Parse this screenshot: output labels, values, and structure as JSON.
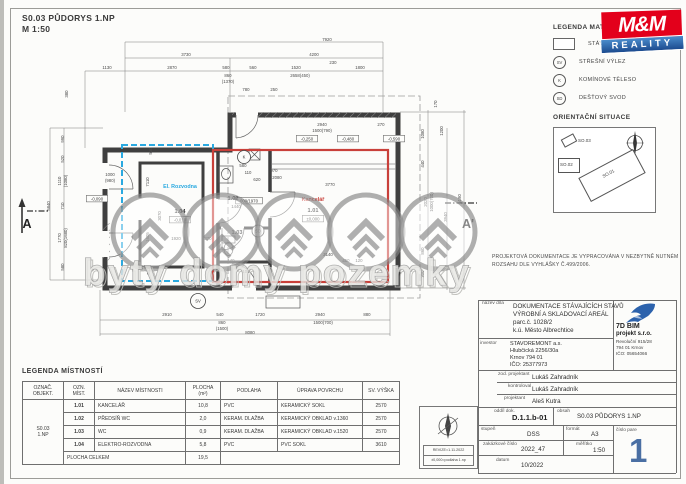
{
  "header": {
    "title": "S0.03 PŮDORYS 1.NP",
    "scale": "M 1:50"
  },
  "colors": {
    "accent_blue": "#2aa9e0",
    "accent_red": "#c9403a",
    "mm_red": "#e3001b",
    "mm_blue_top": "#4a8ccc",
    "mm_blue_bottom": "#1c4b8f",
    "pare_blue": "#4a6fa3",
    "bird_blue": "#2c62ac"
  },
  "watermark": {
    "text": "byty domy pozemky"
  },
  "legend_materials": {
    "title": "LEGENDA MATERIÁLŮ",
    "items": [
      {
        "sym": "swatch",
        "label": "STÁVAJÍCÍ KONSTRUKCE"
      },
      {
        "sym": "SV",
        "label": "STŘEŠNÍ VÝLEZ"
      },
      {
        "sym": "K",
        "label": "KOMÍNOVÉ TĚLESO"
      },
      {
        "sym": "SD",
        "label": "DEŠŤOVÝ SVOD"
      }
    ]
  },
  "mm_logo": {
    "name": "M&M",
    "banner": "REALITY"
  },
  "orientation": {
    "title": "ORIENTAČNÍ SITUACE",
    "buildings": [
      {
        "cls": "so3",
        "label": "SO.03"
      },
      {
        "cls": "so2",
        "label": "SO.02"
      },
      {
        "cls": "so1",
        "label": "SO.01"
      }
    ]
  },
  "note": {
    "line1": "PROJEKTOVÁ DOKUMENTACE JE VYPRACOVÁNA V NEZBYTNĚ NUTNÉM",
    "line2": "ROZSAHU DLE VYHLÁŠKY Č.499/2006."
  },
  "title_block": {
    "nazev_label": "název díla",
    "nazev": [
      "DOKUMENTACE STÁVAJÍCÍCH STAVŮ",
      "VÝROBNÍ A SKLADOVACÍ AREÁL",
      "parc.č. 1028/2",
      "k.ú. Město Albrechtice"
    ],
    "investor_label": "investor",
    "investor": [
      "STAVOREMONT a.s.",
      "Hlubčická 2256/30a",
      "Krnov 794 01",
      "IČO: 25377973"
    ],
    "company": {
      "name": "7D BIM",
      "name2": "projekt s.r.o.",
      "addr": [
        "Revoluční 915/28",
        "794 01 Krnov",
        "IČO: 05654066"
      ]
    },
    "zod_label": "zod. projektant",
    "zod": "Lukáš Zahradník",
    "kontroloval_label": "kontroloval",
    "kontroloval": "Lukáš Zahradník",
    "projektant_label": "projektant",
    "projektant": "Aleš Kutra",
    "oddil_label": "oddíl dok.",
    "oddil": "D.1.1.b-01",
    "obsah_label": "obsah",
    "obsah": "S0.03 PŮDORYS 1.NP",
    "stupen_label": "stupeň",
    "stupen": "DSS",
    "format_label": "formát",
    "format": "A3",
    "pare_label": "číslo pare",
    "pare": "1",
    "zakazka_label": "zakázkové číslo",
    "zakazka": "2022_47",
    "meritko_label": "měřítko",
    "meritko": "1:50",
    "datum_label": "datum",
    "datum": "10/2022"
  },
  "room_table": {
    "title": "LEGENDA MÍSTNOSTÍ",
    "headers": [
      "OZNAČ.\nOBJEKT.",
      "OZN.\nMÍST.",
      "NÁZEV MÍSTNOSTI",
      "PLOCHA\n(m²)",
      "PODLAHA",
      "ÚPRAVA POVRCHU",
      "SV. VÝŠKA"
    ],
    "group": "S0.03\n1.NP",
    "rows": [
      [
        "1.01",
        "KANCELÁŘ",
        "10,8",
        "PVC",
        "KERAMICKÝ SOKL",
        "2570"
      ],
      [
        "1.02",
        "PŘEDSÍŇ WC",
        "2,0",
        "KERAM. DLAŽBA",
        "KERAMICKÝ OBKLAD v.1360",
        "2570"
      ],
      [
        "1.03",
        "WC",
        "0,9",
        "KERAM. DLAŽBA",
        "KERAMICKÝ OBKLAD v.1520",
        "2570"
      ],
      [
        "1.04",
        "ELEKTRO-ROZVODNA",
        "5,8",
        "PVC",
        "PVC SOKL",
        "3610"
      ]
    ],
    "total_label": "PLOCHA CELKEM",
    "total": "19,5"
  },
  "revize": {
    "line1": "REVIZE=1.11.2022",
    "line2": "±0,000=podlaha 1.np"
  },
  "plan": {
    "dims": [
      {
        "t": "7920",
        "x": 327,
        "y": 41
      },
      {
        "t": "3730",
        "x": 186,
        "y": 56
      },
      {
        "t": "4200",
        "x": 314,
        "y": 56
      },
      {
        "t": "1130",
        "x": 107,
        "y": 69
      },
      {
        "t": "2870",
        "x": 172,
        "y": 69
      },
      {
        "t": "580",
        "x": 226,
        "y": 69
      },
      {
        "t": "560",
        "x": 253,
        "y": 69
      },
      {
        "t": "1520",
        "x": 296,
        "y": 69
      },
      {
        "t": "230",
        "x": 333,
        "y": 64
      },
      {
        "t": "1800",
        "x": 360,
        "y": 69
      },
      {
        "t": "860",
        "x": 228,
        "y": 77
      },
      {
        "t": "(1370)",
        "x": 228,
        "y": 83
      },
      {
        "t": "2658(450)",
        "x": 300,
        "y": 77
      },
      {
        "t": "780",
        "x": 246,
        "y": 91
      },
      {
        "t": "250",
        "x": 274,
        "y": 91
      },
      {
        "t": "380",
        "x": 68,
        "y": 94,
        "v": true
      },
      {
        "t": "2940",
        "x": 322,
        "y": 126
      },
      {
        "t": "1500(790)",
        "x": 322,
        "y": 132
      },
      {
        "t": "270",
        "x": 381,
        "y": 126
      },
      {
        "t": "990",
        "x": 64,
        "y": 139,
        "v": true
      },
      {
        "t": "520",
        "x": 64,
        "y": 159,
        "v": true
      },
      {
        "t": "1110",
        "x": 61,
        "y": 181,
        "v": true
      },
      {
        "t": "(1080)",
        "x": 67,
        "y": 181,
        "v": true
      },
      {
        "t": "710",
        "x": 64,
        "y": 206,
        "v": true
      },
      {
        "t": "1770",
        "x": 61,
        "y": 238,
        "v": true
      },
      {
        "t": "820(1680)",
        "x": 67,
        "y": 238,
        "v": true
      },
      {
        "t": "580",
        "x": 64,
        "y": 267,
        "v": true
      },
      {
        "t": "5840",
        "x": 50,
        "y": 206,
        "v": true
      },
      {
        "t": "1000",
        "x": 110,
        "y": 176
      },
      {
        "t": "(980)",
        "x": 110,
        "y": 182
      },
      {
        "t": "530",
        "x": 152,
        "y": 151,
        "v": true
      },
      {
        "t": "7110",
        "x": 149,
        "y": 182,
        "v": true
      },
      {
        "t": "3070",
        "x": 161,
        "y": 216,
        "v": true
      },
      {
        "t": "1605",
        "x": 149,
        "y": 237,
        "v": true
      },
      {
        "t": "513",
        "x": 150,
        "y": 271,
        "v": true
      },
      {
        "t": "1920",
        "x": 176,
        "y": 240
      },
      {
        "t": "370",
        "x": 208,
        "y": 240
      },
      {
        "t": "580",
        "x": 243,
        "y": 167
      },
      {
        "t": "110",
        "x": 248,
        "y": 174
      },
      {
        "t": "620",
        "x": 257,
        "y": 181
      },
      {
        "t": "970",
        "x": 274,
        "y": 172
      },
      {
        "t": "2080",
        "x": 277,
        "y": 179
      },
      {
        "t": "3770",
        "x": 330,
        "y": 186
      },
      {
        "t": "1440",
        "x": 236,
        "y": 208
      },
      {
        "t": "790",
        "x": 221,
        "y": 247,
        "v": true
      },
      {
        "t": "100",
        "x": 246,
        "y": 273
      },
      {
        "t": "140",
        "x": 231,
        "y": 262
      },
      {
        "t": "3140",
        "x": 328,
        "y": 256
      },
      {
        "t": "450",
        "x": 346,
        "y": 262
      },
      {
        "t": "120",
        "x": 359,
        "y": 262
      },
      {
        "t": "170",
        "x": 437,
        "y": 104,
        "v": true
      },
      {
        "t": "1080",
        "x": 424,
        "y": 134,
        "v": true
      },
      {
        "t": "1200",
        "x": 443,
        "y": 131,
        "v": true
      },
      {
        "t": "440",
        "x": 424,
        "y": 164,
        "v": true
      },
      {
        "t": "2020",
        "x": 427,
        "y": 202,
        "v": true
      },
      {
        "t": "1000(700)",
        "x": 433,
        "y": 202,
        "v": true
      },
      {
        "t": "3940",
        "x": 447,
        "y": 217,
        "v": true
      },
      {
        "t": "5190",
        "x": 461,
        "y": 199,
        "v": true
      },
      {
        "t": "860",
        "x": 424,
        "y": 251,
        "v": true
      },
      {
        "t": "300",
        "x": 424,
        "y": 274,
        "v": true
      },
      {
        "t": "2910",
        "x": 167,
        "y": 316
      },
      {
        "t": "540",
        "x": 220,
        "y": 316
      },
      {
        "t": "860",
        "x": 222,
        "y": 324
      },
      {
        "t": "(1500)",
        "x": 222,
        "y": 330
      },
      {
        "t": "1720",
        "x": 260,
        "y": 316
      },
      {
        "t": "2940",
        "x": 320,
        "y": 316
      },
      {
        "t": "1500(700)",
        "x": 323,
        "y": 324
      },
      {
        "t": "880",
        "x": 367,
        "y": 316
      },
      {
        "t": "8080",
        "x": 250,
        "y": 334
      }
    ],
    "elev": [
      {
        "t": "-0,250",
        "x": 307,
        "y": 140
      },
      {
        "t": "-0,480",
        "x": 348,
        "y": 140
      },
      {
        "t": "-0,590",
        "x": 394,
        "y": 140
      },
      {
        "t": "-0,090",
        "x": 97,
        "y": 200
      },
      {
        "t": "-0,010",
        "x": 180,
        "y": 221
      },
      {
        "t": "±0,000",
        "x": 313,
        "y": 220
      },
      {
        "t": "600/1970",
        "x": 249,
        "y": 202
      }
    ],
    "rooms": [
      {
        "t": "El. Rozvodna",
        "x": 180,
        "y": 188,
        "c": "cyan"
      },
      {
        "t": "1.04",
        "x": 180,
        "y": 213,
        "c": "num"
      },
      {
        "t": "1.02",
        "x": 233,
        "y": 200,
        "c": "num"
      },
      {
        "t": "1.03",
        "x": 237,
        "y": 234,
        "c": "num"
      },
      {
        "t": "Kancelář",
        "x": 313,
        "y": 201,
        "c": "red"
      },
      {
        "t": "1.01",
        "x": 313,
        "y": 212,
        "c": "num"
      }
    ],
    "symbols": [
      {
        "t": "K",
        "x": 244,
        "y": 157,
        "r": 6.5
      },
      {
        "t": "SD",
        "x": 258,
        "y": 231,
        "r": 6
      },
      {
        "t": "SV",
        "x": 198,
        "y": 301,
        "r": 7.5
      }
    ],
    "markers": [
      {
        "t": "A",
        "x": 27,
        "y": 228
      },
      {
        "t": "A'",
        "x": 468,
        "y": 228
      }
    ]
  }
}
